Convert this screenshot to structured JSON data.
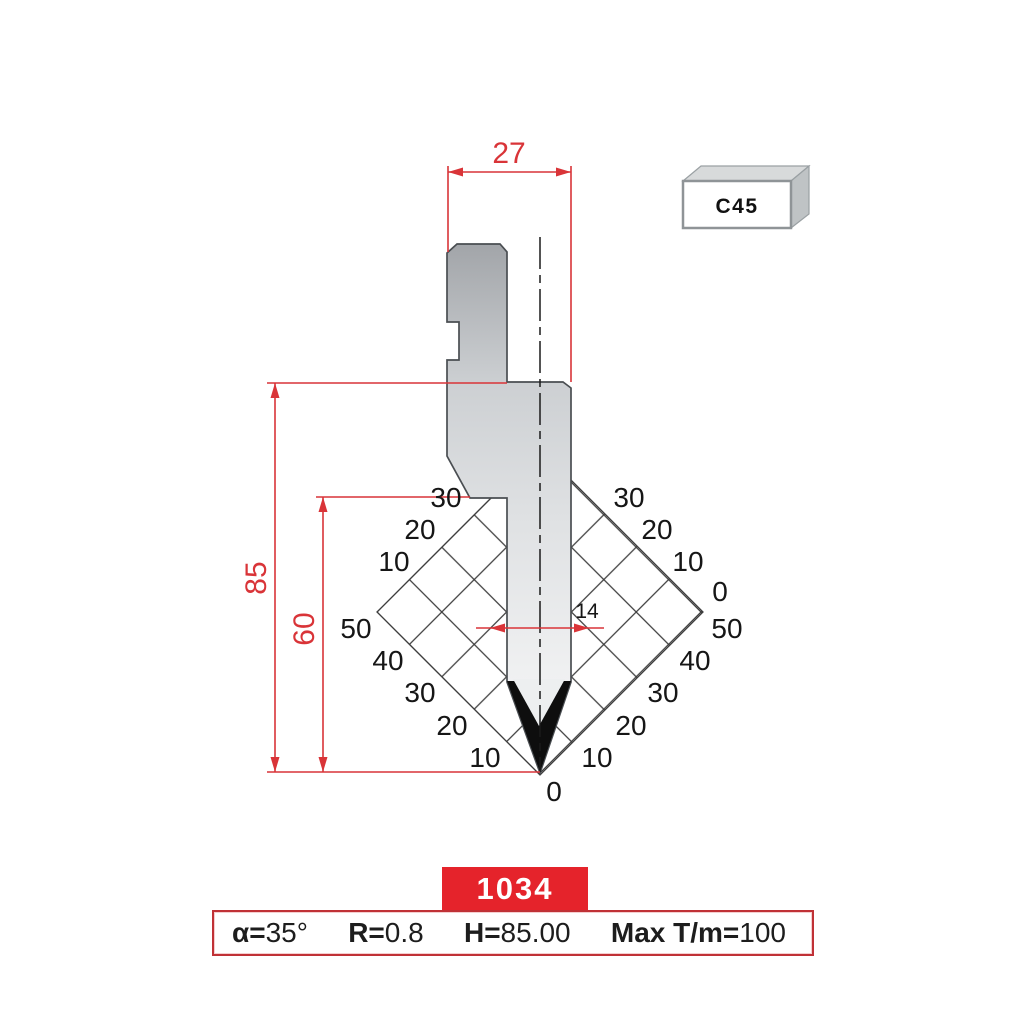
{
  "drawing": {
    "dim_top_width": "27",
    "dim_total_height": "85",
    "dim_working_height": "60",
    "dim_tip_width": "14"
  },
  "material_badge": {
    "label": "C45"
  },
  "angle_scale": {
    "left_upper": [
      "30",
      "20",
      "10"
    ],
    "left_lower": [
      "50",
      "40",
      "30",
      "20",
      "10"
    ],
    "right_upper": [
      "30",
      "20",
      "10",
      "0"
    ],
    "right_lower": [
      "50",
      "40",
      "30",
      "20",
      "10"
    ],
    "bottom_zero": "0"
  },
  "part_badge": {
    "number": "1034"
  },
  "spec_bar": {
    "items": [
      {
        "label": "α=",
        "value": "35°"
      },
      {
        "label": "R=",
        "value": "0.8"
      },
      {
        "label": "H=",
        "value": "85.00"
      },
      {
        "label": "Max T/m=",
        "value": "100"
      }
    ]
  },
  "colors": {
    "dimension_red": "#d93438",
    "badge_red": "#e5232b",
    "spec_border_red": "#c03136",
    "grid_line": "#3d3d3d"
  }
}
